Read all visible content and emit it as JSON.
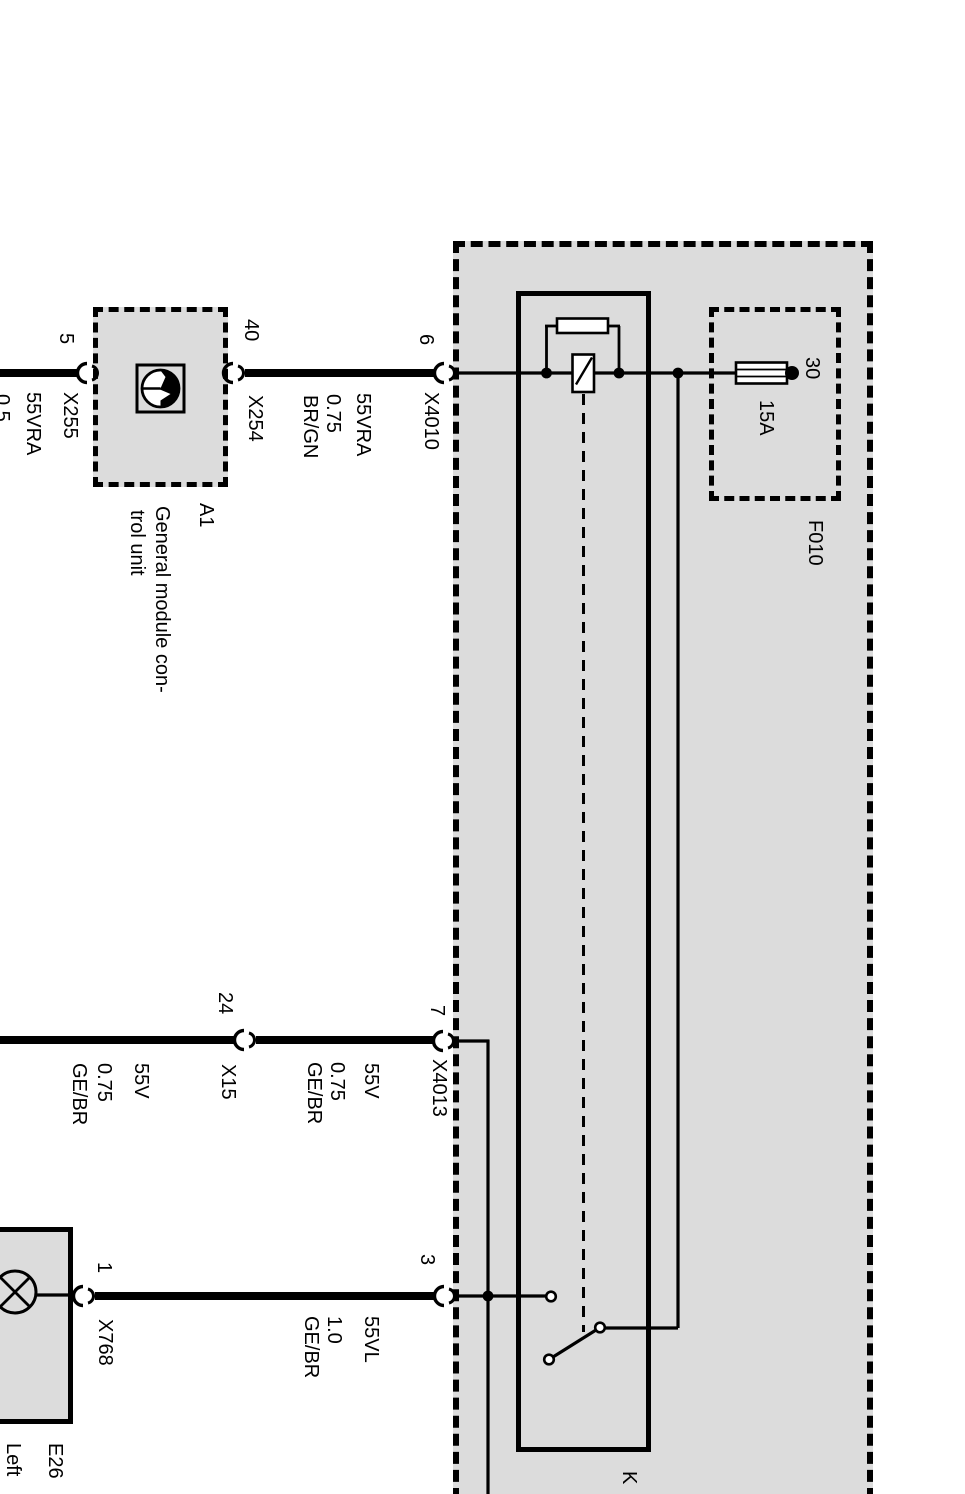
{
  "power_distribution_box": {
    "fuse": {
      "designation": "F010",
      "rating": "15A",
      "terminal": "30"
    },
    "relay": {
      "designation": "K"
    }
  },
  "components": {
    "a1": {
      "designation": "A1",
      "description_line1": "General module con-",
      "description_line2": "trol unit"
    },
    "e26": {
      "designation": "E26",
      "description": "Left"
    }
  },
  "connectors": {
    "x255": {
      "label": "X255",
      "pin": "5"
    },
    "x254": {
      "label": "X254",
      "pin": "40"
    },
    "x4010": {
      "label": "X4010",
      "pin": "6"
    },
    "x15": {
      "label": "X15",
      "pin": "24"
    },
    "x4013": {
      "label": "X4013",
      "pin": "7"
    },
    "x768": {
      "label": "X768",
      "pin": "1"
    },
    "box_bottom": {
      "pin": "3"
    }
  },
  "wires": {
    "left_top": {
      "circuit": "55VRA",
      "gauge": "0.5"
    },
    "a1_to_box": {
      "circuit": "55VRA",
      "gauge": "0.75",
      "color": "BR/GN"
    },
    "left_middle": {
      "circuit": "55V",
      "gauge": "0.75",
      "color": "GE/BR"
    },
    "middle_to_box": {
      "circuit": "55V",
      "gauge": "0.75",
      "color": "GE/BR"
    },
    "lamp_to_box": {
      "circuit": "55VL",
      "gauge": "1.0",
      "color": "GE/BR"
    }
  },
  "colors": {
    "background": "#ffffff",
    "box_fill": "#dcdcdc",
    "line": "#000000"
  }
}
